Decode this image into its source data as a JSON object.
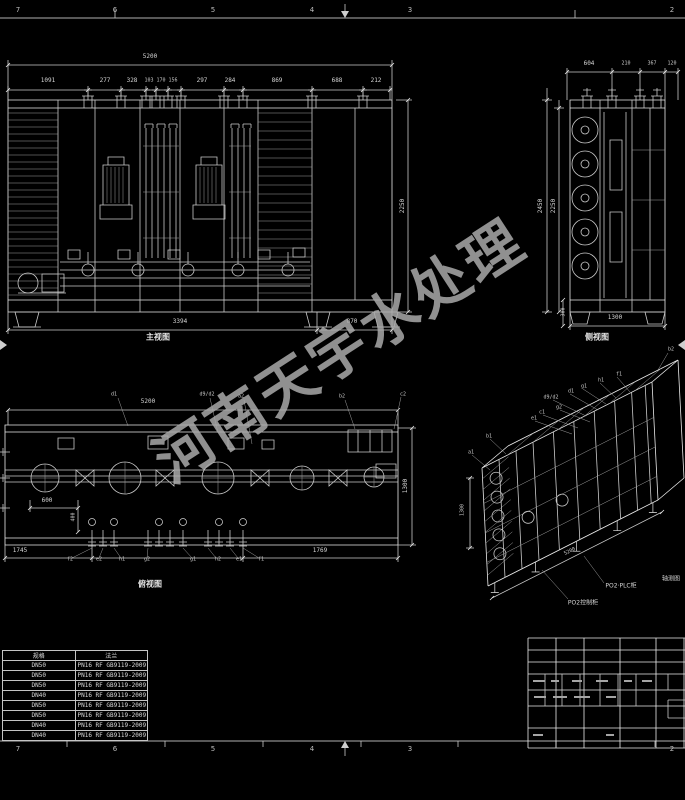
{
  "sheet": {
    "zones_top": [
      "7",
      "6",
      "5",
      "4",
      "3",
      "2"
    ],
    "zones_bottom": [
      "7",
      "6",
      "5",
      "4",
      "3",
      "2"
    ]
  },
  "watermark": {
    "text": "河南天宇水处理",
    "color": "#aaaaaa"
  },
  "front_view": {
    "label": "主视图",
    "dim_total": "5200",
    "dim_segments": [
      "1091",
      "277",
      "328",
      "103",
      "170",
      "156",
      "297",
      "284",
      "869",
      "688",
      "212"
    ],
    "dim_height": "2250",
    "dim_base_left": "3394",
    "dim_base_right": "870"
  },
  "side_view": {
    "label": "侧视图",
    "dim_segments": [
      "604",
      "210",
      "367",
      "120"
    ],
    "dim_height_outer": "2450",
    "dim_height_inner": "2250",
    "dim_base": "1300",
    "dim_foot": "300"
  },
  "plan_view": {
    "label": "俯视图",
    "dim_total": "5200",
    "dim_width": "1300",
    "dim_base_left": "1745",
    "dim_base_right": "1769",
    "dim_inner_h": "600",
    "dim_inner_v": "400",
    "leaders_top": [
      "d1",
      "d9/d2",
      "a2",
      "b2",
      "c2"
    ],
    "leaders_bottom": [
      "f2",
      "e2",
      "h1",
      "g2",
      "g1",
      "h2",
      "e1",
      "f1"
    ]
  },
  "iso_view": {
    "label": "轴测图",
    "labels": [
      "b2",
      "f1",
      "h1",
      "g1",
      "d1",
      "d9/d2",
      "g2",
      "c1",
      "e1",
      "b1",
      "a1"
    ],
    "dim_height": "1300",
    "dim_length": "5200",
    "callout_plc": "PO2·PLC柜",
    "callout_control": "PO2控制柜"
  },
  "flange_table": {
    "headers": [
      "规格",
      "法兰"
    ],
    "rows": [
      [
        "DN50",
        "PN16 RF GB9119-2009"
      ],
      [
        "DN50",
        "PN16 RF GB9119-2009"
      ],
      [
        "DN50",
        "PN16 RF GB9119-2009"
      ],
      [
        "DN40",
        "PN16 RF GB9119-2009"
      ],
      [
        "DN50",
        "PN16 RF GB9119-2009"
      ],
      [
        "DN50",
        "PN16 RF GB9119-2009"
      ],
      [
        "DN40",
        "PN16 RF GB9119-2009"
      ],
      [
        "DN40",
        "PN16 RF GB9119-2009"
      ]
    ]
  }
}
